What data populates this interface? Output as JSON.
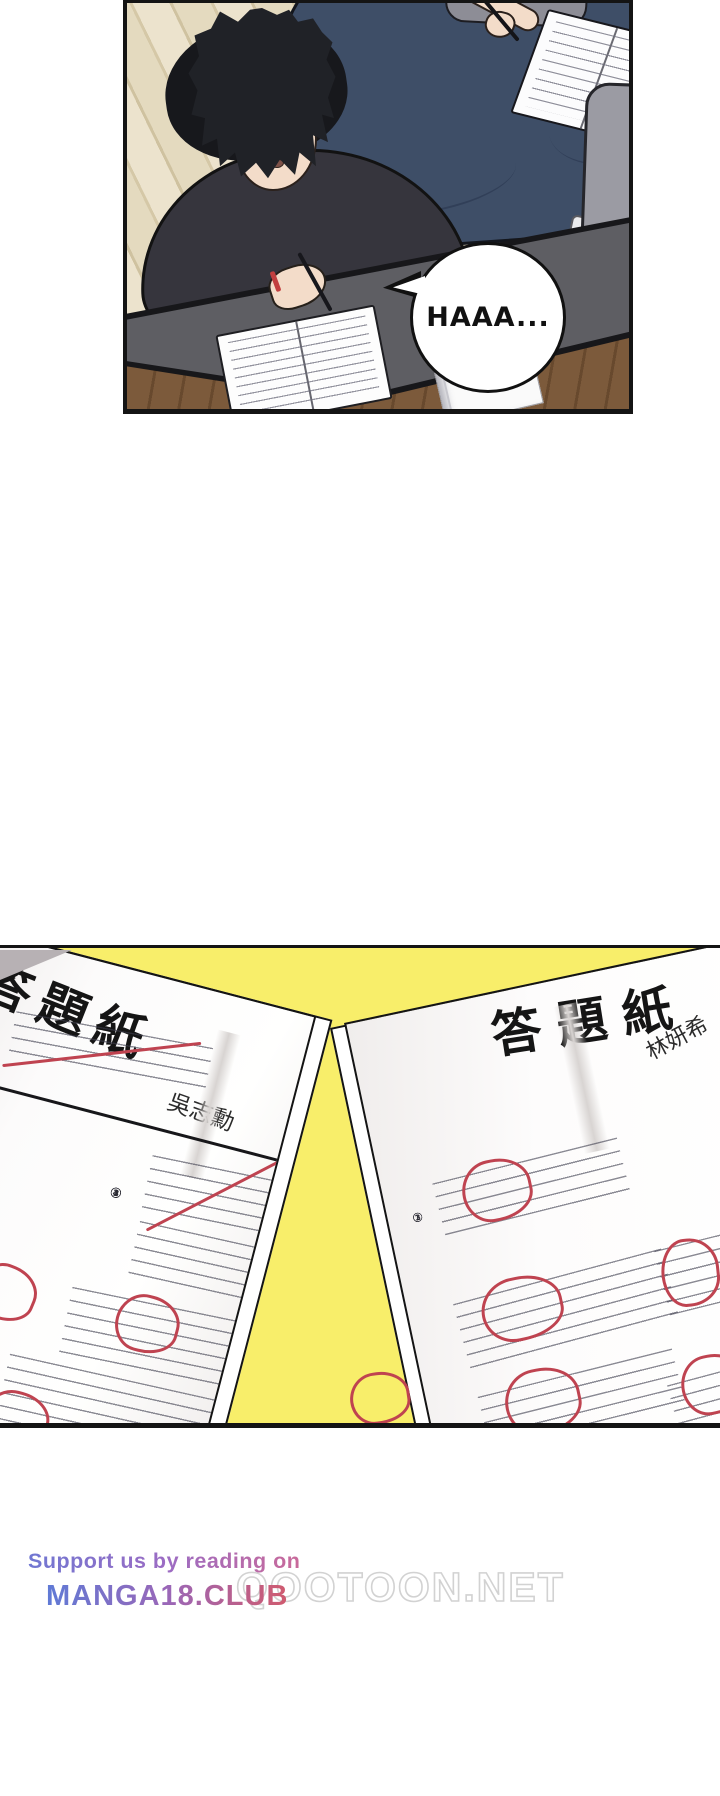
{
  "panel1": {
    "speech_bubble": {
      "text": "HAAA..."
    }
  },
  "panel2": {
    "left_sheet": {
      "title": "答題紙",
      "student_name": "吳志勳",
      "question_numbers": [
        "①",
        "②",
        "③",
        "④"
      ]
    },
    "right_sheet": {
      "title": "答題紙",
      "student_name": "林妍希",
      "question_numbers": [
        "①",
        "②",
        "③"
      ]
    }
  },
  "watermark": {
    "support_text": "Support us by reading on",
    "site_primary": "MANGA18.CLUB",
    "site_secondary": "QOOTOON.NET"
  },
  "colors": {
    "panel2_background": "#f8ee6a",
    "grade_mark_red": "#bf4350",
    "bed_navy": "#3e4e67",
    "desk_gray": "#5e5e63",
    "floor_wood_light": "#e0d5b8",
    "floor_wood_dark": "#7c5a3b"
  }
}
